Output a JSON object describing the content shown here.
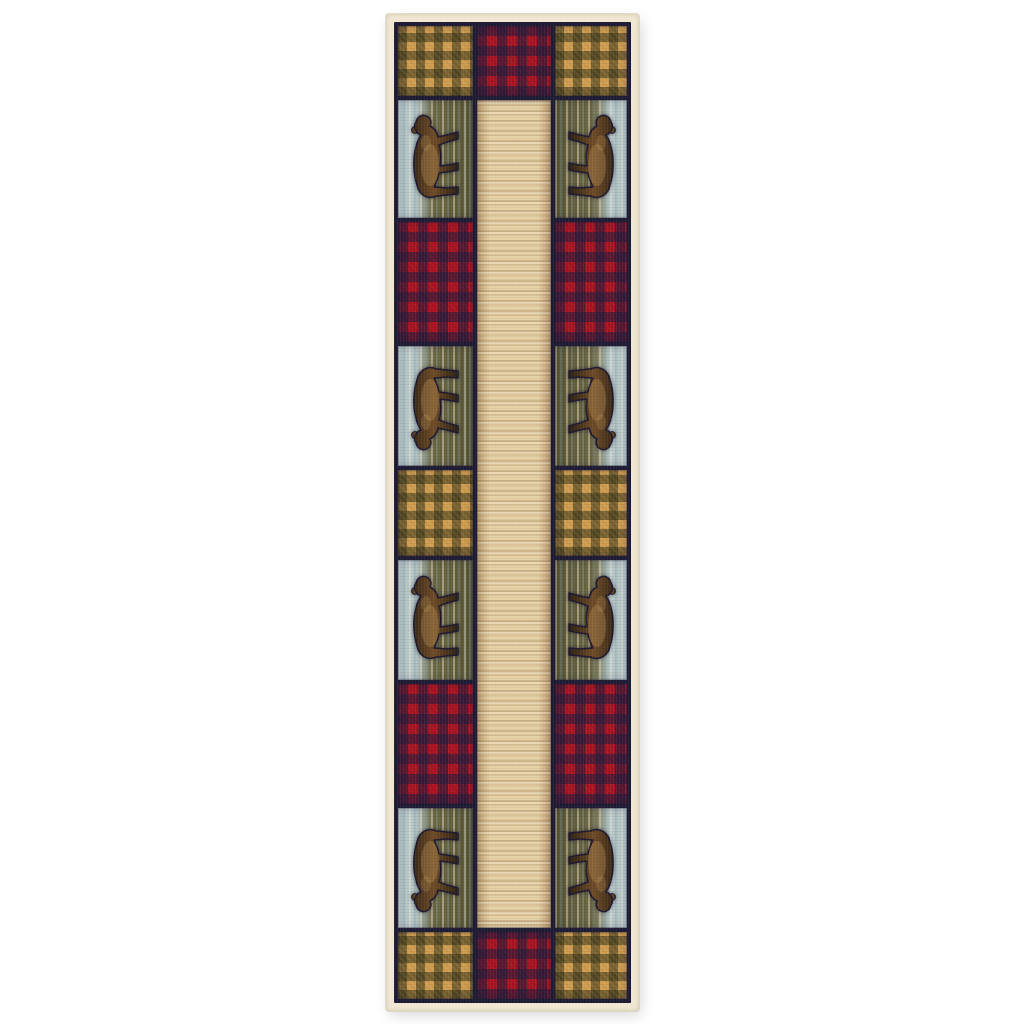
{
  "image": {
    "type": "product-photo",
    "subject": "rustic lodge patchwork runner rug with walking-bear panels, red buffalo plaid and gold gingham check blocks around a beige center field",
    "background_color": "#ffffff"
  },
  "rug": {
    "shape": "runner",
    "position": {
      "left": 386,
      "top": 14,
      "width": 253,
      "height": 997
    },
    "border_color": "#f0e7d2",
    "frame_color": "#1e1b34",
    "palette": {
      "gingham_gold": "#cd9a4b",
      "gingham_shade": "rgba(48,46,18,0.55)",
      "plaid_red": "#ab1522",
      "plaid_shade": "rgba(32,28,62,0.58)",
      "field_beige": "#e7d2a8",
      "field_tan": "#c2a172",
      "panel_sky": "#b7c8ca",
      "panel_ground": "#6d6742",
      "panel_ground_dark": "#575332",
      "bear_dark": "#31241a",
      "bear_mid": "#6f4b26",
      "bear_light": "#c49a5c"
    },
    "motifs": [
      "walking-bear",
      "buffalo-plaid",
      "gingham-check",
      "birch-sky-streaks",
      "beige-center-field"
    ],
    "grid": {
      "columns": [
        75,
        74,
        72
      ],
      "gap": 4,
      "rows": [
        {
          "height": 70,
          "cells": [
            "gingham",
            "plaid",
            "gingham"
          ]
        },
        {
          "height": 118,
          "cells": [
            "bear-left",
            "field",
            "bear-right"
          ],
          "bear_heads": "up"
        },
        {
          "height": 120,
          "cells": [
            "plaid",
            "field",
            "plaid"
          ]
        },
        {
          "height": 120,
          "cells": [
            "bear-left",
            "field",
            "bear-right"
          ],
          "bear_heads": "down"
        },
        {
          "height": 86,
          "cells": [
            "gingham",
            "field",
            "gingham"
          ]
        },
        {
          "height": 120,
          "cells": [
            "bear-left",
            "field",
            "bear-right"
          ],
          "bear_heads": "up"
        },
        {
          "height": 120,
          "cells": [
            "plaid",
            "field",
            "plaid"
          ]
        },
        {
          "height": 120,
          "cells": [
            "bear-left",
            "field",
            "bear-right"
          ],
          "bear_heads": "down"
        },
        {
          "height": 67,
          "cells": [
            "gingham",
            "plaid",
            "gingham"
          ]
        }
      ]
    }
  }
}
